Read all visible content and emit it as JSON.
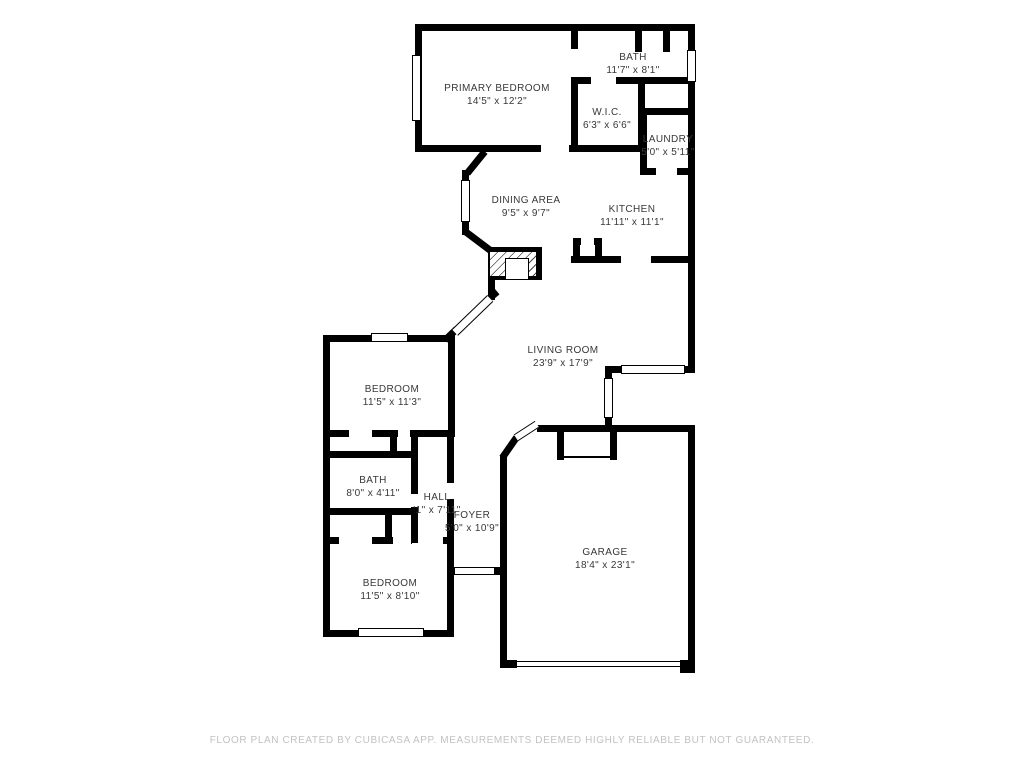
{
  "plan": {
    "type": "floor-plan",
    "colors": {
      "wall": "#000000",
      "label_text": "#383838",
      "footer_text": "#c2c2c2",
      "background": "#ffffff"
    }
  },
  "rooms": [
    {
      "name": "PRIMARY BEDROOM",
      "dims": "14'5\" x 12'2\""
    },
    {
      "name": "BATH",
      "dims": "11'7\" x 8'1\""
    },
    {
      "name": "W.I.C.",
      "dims": "6'3\" x 6'6\""
    },
    {
      "name": "LAUNDRY",
      "dims": "5'0\" x 5'11\""
    },
    {
      "name": "DINING AREA",
      "dims": "9'5\" x 9'7\""
    },
    {
      "name": "KITCHEN",
      "dims": "11'11\" x 11'1\""
    },
    {
      "name": "LIVING ROOM",
      "dims": "23'9\" x 17'9\""
    },
    {
      "name": "BEDROOM",
      "dims": "11'5\" x 11'3\""
    },
    {
      "name": "BATH",
      "dims": "8'0\" x 4'11\""
    },
    {
      "name": "HALL",
      "dims": "'1\" x 7'11\""
    },
    {
      "name": "FOYER",
      "dims": "5'0\" x 10'9\""
    },
    {
      "name": "BEDROOM",
      "dims": "11'5\" x 8'10\""
    },
    {
      "name": "GARAGE",
      "dims": "18'4\" x 23'1\""
    }
  ],
  "footer": {
    "disclaimer": "FLOOR PLAN CREATED BY CUBICASA APP. MEASUREMENTS DEEMED HIGHLY RELIABLE BUT NOT GUARANTEED."
  }
}
